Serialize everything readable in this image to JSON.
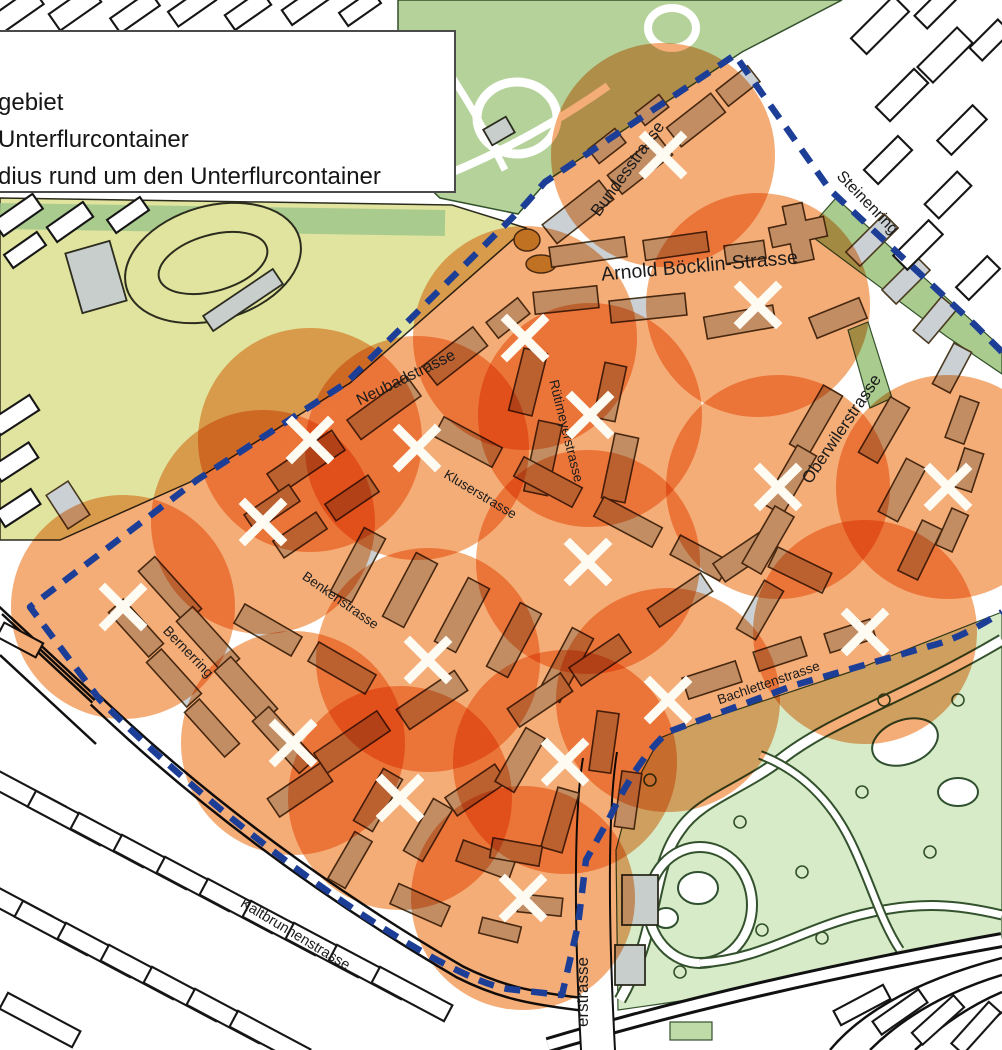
{
  "legend": {
    "items": [
      {
        "label": "gebiet"
      },
      {
        "label": "Unterflurcontainer"
      },
      {
        "label": "dius rund um den Unterflurcontainer"
      }
    ]
  },
  "map": {
    "streets": [
      {
        "name": "Bundesstrasse",
        "x": 632,
        "y": 172,
        "rotate": -54,
        "size": 17
      },
      {
        "name": "Steinenring",
        "x": 864,
        "y": 206,
        "rotate": 46,
        "size": 16
      },
      {
        "name": "Arnold Böcklin-Strasse",
        "x": 700,
        "y": 272,
        "rotate": -5,
        "size": 19.5
      },
      {
        "name": "Neubadstrasse",
        "x": 408,
        "y": 382,
        "rotate": -26,
        "size": 16
      },
      {
        "name": "Rütimeyerstrasse",
        "x": 562,
        "y": 432,
        "rotate": 76,
        "size": 13.5
      },
      {
        "name": "Oberwilerstrasse",
        "x": 846,
        "y": 432,
        "rotate": -56,
        "size": 17
      },
      {
        "name": "Kluserstrasse",
        "x": 478,
        "y": 498,
        "rotate": 31,
        "size": 13.5
      },
      {
        "name": "Benkenstrasse",
        "x": 338,
        "y": 604,
        "rotate": 35,
        "size": 13.5
      },
      {
        "name": "Bernerring",
        "x": 185,
        "y": 655,
        "rotate": 46,
        "size": 14
      },
      {
        "name": "Bachlettenstrasse",
        "x": 770,
        "y": 687,
        "rotate": -19,
        "size": 13.5
      },
      {
        "name": "Kaltbrunnenstrasse",
        "x": 293,
        "y": 938,
        "rotate": 31,
        "size": 14.5
      },
      {
        "name": "erstrasse",
        "x": 588,
        "y": 992,
        "rotate": -90,
        "size": 17
      }
    ],
    "containers": {
      "count": 18,
      "positions": [
        {
          "x": 663,
          "y": 155
        },
        {
          "x": 758,
          "y": 305
        },
        {
          "x": 525,
          "y": 338
        },
        {
          "x": 590,
          "y": 415
        },
        {
          "x": 310,
          "y": 440
        },
        {
          "x": 417,
          "y": 448
        },
        {
          "x": 778,
          "y": 487
        },
        {
          "x": 948,
          "y": 487
        },
        {
          "x": 263,
          "y": 522
        },
        {
          "x": 588,
          "y": 562
        },
        {
          "x": 123,
          "y": 607
        },
        {
          "x": 865,
          "y": 632
        },
        {
          "x": 428,
          "y": 660
        },
        {
          "x": 668,
          "y": 700
        },
        {
          "x": 293,
          "y": 743
        },
        {
          "x": 565,
          "y": 762
        },
        {
          "x": 400,
          "y": 798
        },
        {
          "x": 523,
          "y": 898
        }
      ]
    },
    "radius_px": 112,
    "colors": {
      "boundary": "#1d3e96",
      "radius_fill": "#f5ad78",
      "marker": "#fdfbf2",
      "park_green": "#b5d29a",
      "zoo_green": "#d7ebc9",
      "field_green": "#e0e49e",
      "strip_green": "#a9cb8d",
      "building_gebiet": "#cbd0d4",
      "building_outside": "#ffffff"
    }
  }
}
